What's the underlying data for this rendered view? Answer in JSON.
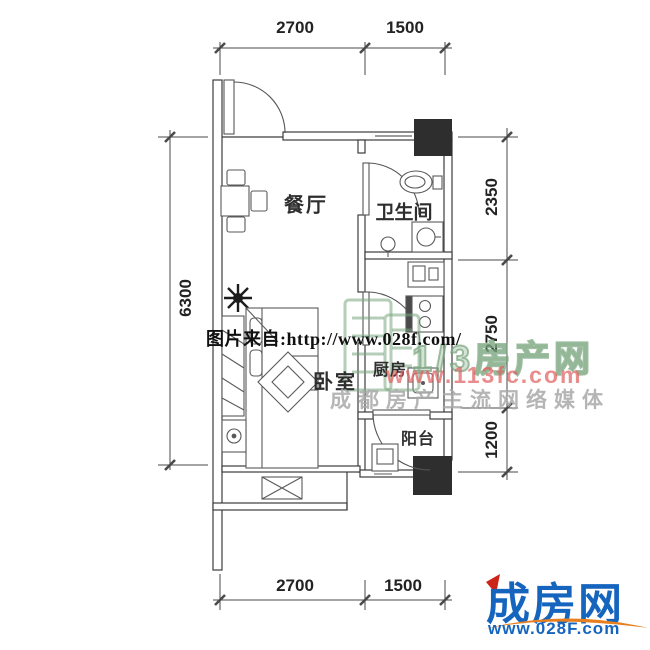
{
  "plan": {
    "rooms": [
      {
        "id": "dining",
        "label": "餐厅"
      },
      {
        "id": "bathroom",
        "label": "卫生间"
      },
      {
        "id": "bedroom",
        "label": "卧室"
      },
      {
        "id": "kitchen",
        "label": "厨房"
      },
      {
        "id": "balcony",
        "label": "阳台"
      }
    ],
    "dimensions": {
      "top": [
        {
          "label": "2700"
        },
        {
          "label": "1500"
        }
      ],
      "bottom": [
        {
          "label": "2700"
        },
        {
          "label": "1500"
        }
      ],
      "left": [
        {
          "label": "6300"
        }
      ],
      "right": [
        {
          "label": "2350"
        },
        {
          "label": "2750"
        },
        {
          "label": "1200"
        }
      ]
    }
  },
  "watermarks": {
    "source_line": "图片来自:http://www.028f.com/",
    "brand_green": "1/3房产网",
    "brand_red_url": "www.113fc.com",
    "slogan": "成都房产主流网络媒体"
  },
  "footer_logo": {
    "brand": "成房网",
    "url": "www.028F.com"
  },
  "colors": {
    "line": "#3c3c3c",
    "column": "#2e2e2e",
    "logo_blue": "#1565bf",
    "logo_orange": "#e77f1e",
    "logo_red": "#cc2418",
    "wm_green": "#86ab8a",
    "wm_red": "#e05f5f",
    "wm_gray": "#a8a8a8"
  }
}
